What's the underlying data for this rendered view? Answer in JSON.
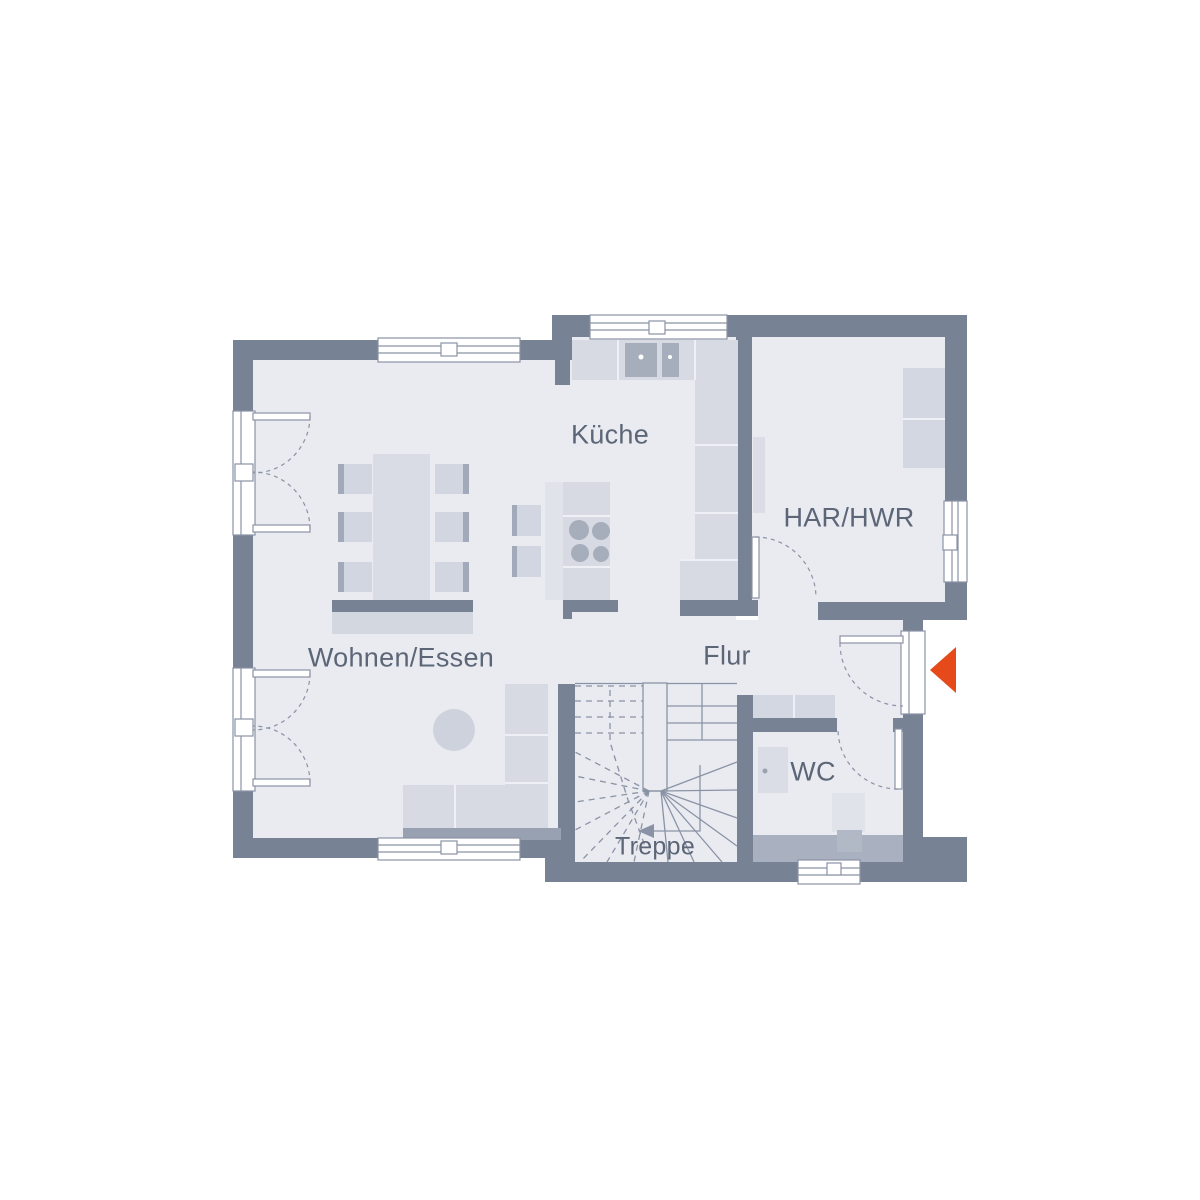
{
  "plan": {
    "rooms": [
      {
        "id": "wohnen-essen",
        "label": "Wohnen/Essen"
      },
      {
        "id": "kueche",
        "label": "Küche"
      },
      {
        "id": "har-hwr",
        "label": "HAR/HWR"
      },
      {
        "id": "flur",
        "label": "Flur"
      },
      {
        "id": "wc",
        "label": "WC"
      },
      {
        "id": "treppe",
        "label": "Treppe"
      }
    ],
    "entrance_marker": "arrow-left",
    "colors": {
      "wall": "#778295",
      "floor": "#E9EBF1",
      "furniture_light": "#D7DAE3",
      "furniture_lighter": "#E0E3EA",
      "furniture_medium": "#C9CEDA",
      "accent_dark": "#A2AABA",
      "sofa_base": "#98A1B2",
      "wc_plinth": "#A9B0BF",
      "outline": "#8A93A5",
      "entrance_arrow": "#E6491A",
      "label_text": "#5C6677",
      "window_fill": "#FFFFFF"
    }
  }
}
